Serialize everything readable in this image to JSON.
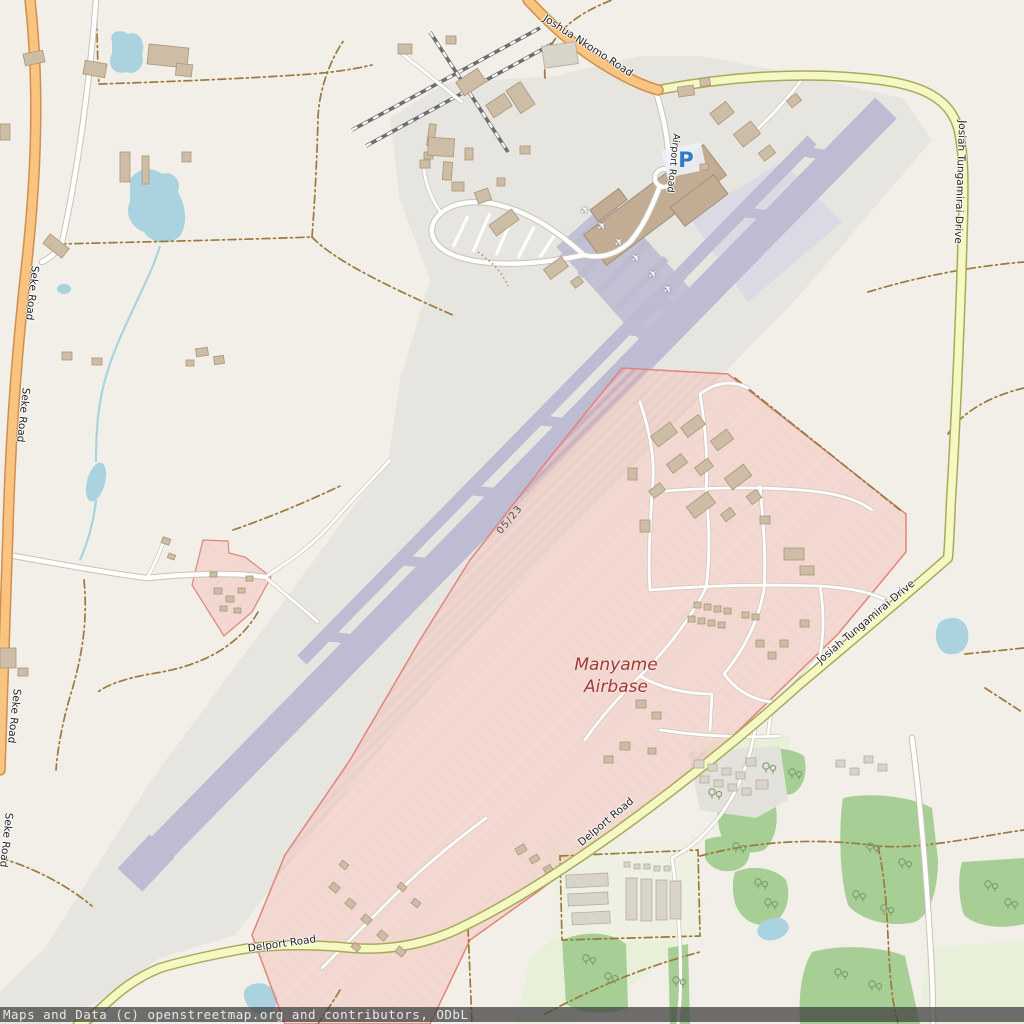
{
  "map": {
    "labels": {
      "joshua_nkomo_road": "Joshua Nkomo Road",
      "josiah_tungamirai_drive": "Josiah Tungamirai Drive",
      "seke_road": "Seke Road",
      "delport_road": "Delport Road",
      "airport_road": "Airport Road",
      "runway_designation": "05/23",
      "airbase_name_line1": "Manyame",
      "airbase_name_line2": "Airbase"
    },
    "icons": {
      "aircraft_gate": "✈",
      "parking": "P"
    },
    "colors": {
      "background": "#f2efe9",
      "airport_ground": "#e7e5e0",
      "runway": "#bdbcd2",
      "primary_road": "#f8c47f",
      "secondary_road": "#f5f8c2",
      "military_area_border": "#e4837a",
      "water": "#aad3df",
      "wood": "#a6ce95",
      "building": "#cdbda6",
      "airbase_label": "#9e3a36",
      "parking_blue": "#2f7cc4"
    }
  },
  "attribution": {
    "text": "Maps and Data (c) openstreetmap.org and contributors, ODbL"
  }
}
